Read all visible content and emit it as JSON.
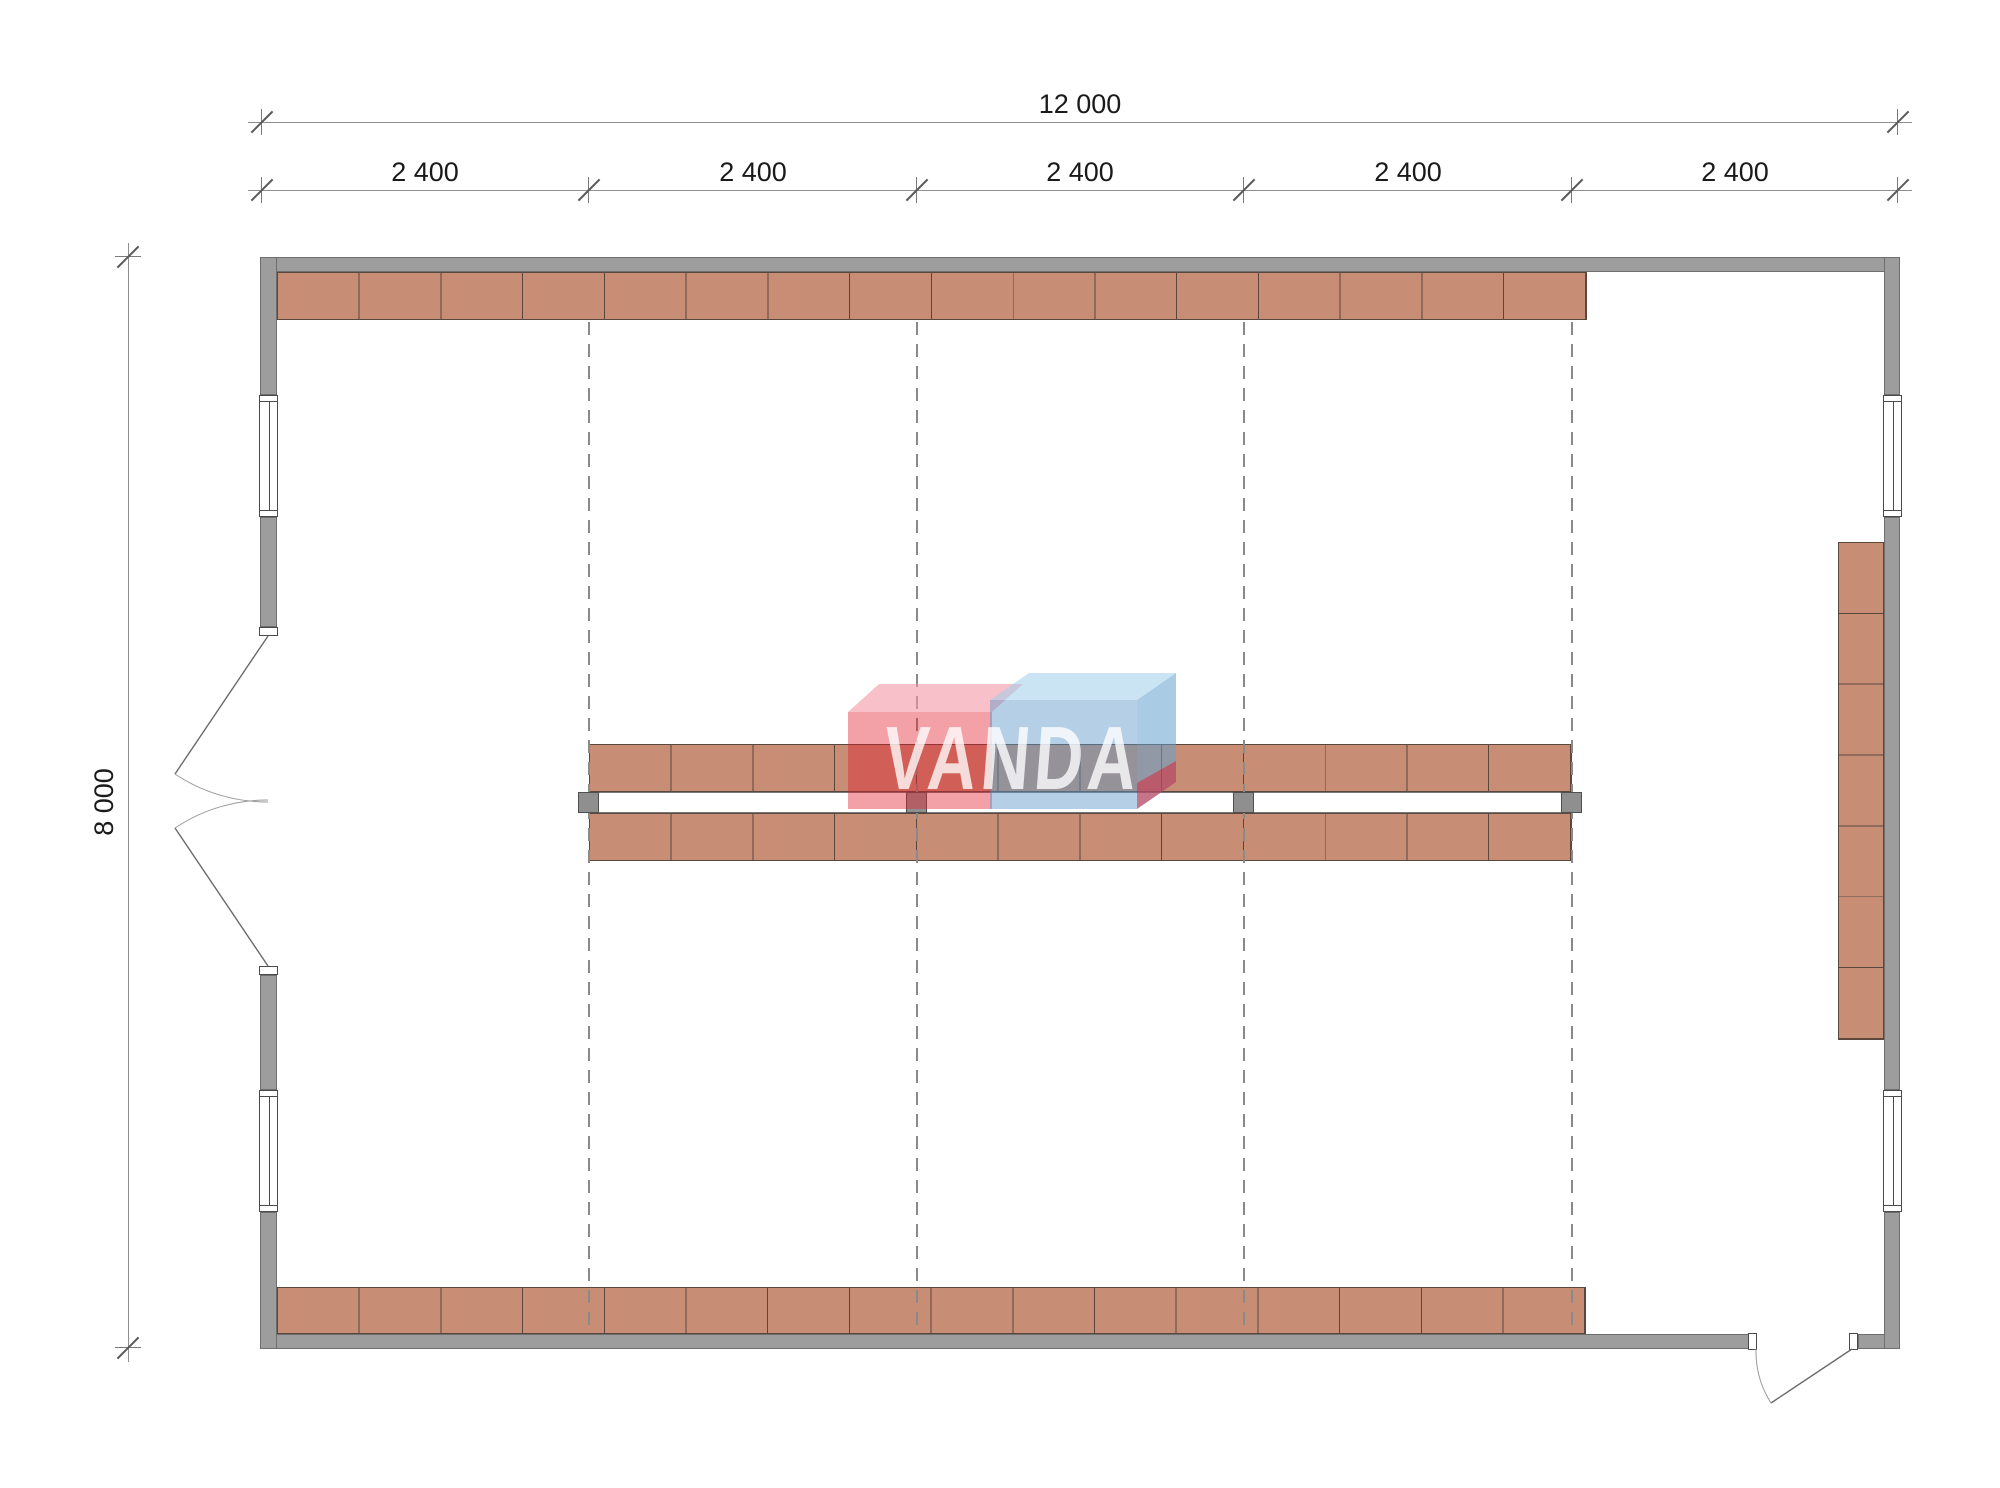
{
  "drawing": {
    "type": "architectural floor plan",
    "dimensions": {
      "overall_width": "12 000",
      "overall_height": "8 000",
      "bays": [
        "2 400",
        "2 400",
        "2 400",
        "2 400",
        "2 400"
      ]
    },
    "watermark": {
      "text": "VANDA",
      "red": "#e2303d",
      "blue": "#5a96c8"
    },
    "colors": {
      "wall": "#9d9d9d",
      "shelf": "#c78e75",
      "grid_line": "#8a8a8a",
      "dimension_text": "#1a1a1a"
    }
  }
}
